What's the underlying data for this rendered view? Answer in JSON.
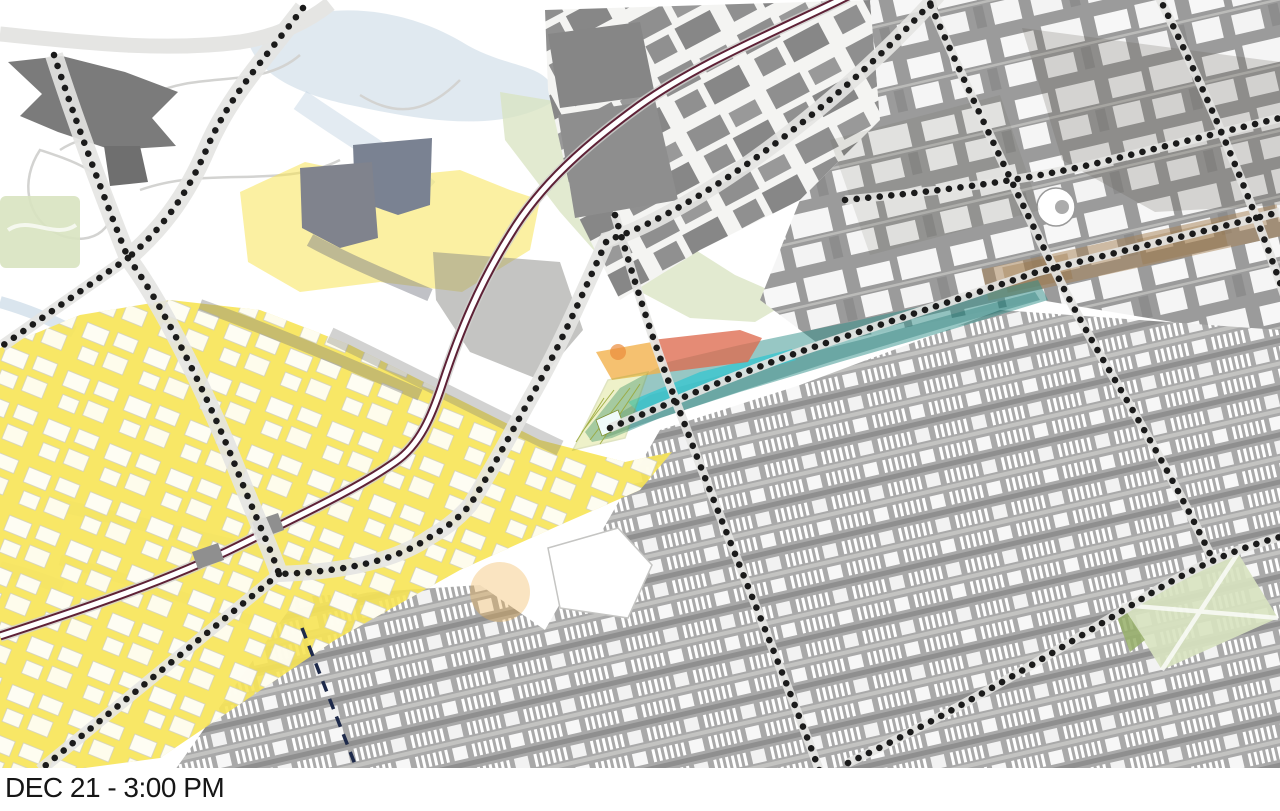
{
  "caption": "DEC 21 - 3:00 PM",
  "map": {
    "kind": "solar-shadow-study-plan",
    "date_label": "DEC 21",
    "time_label": "3:00 PM",
    "colors": {
      "background": "#FFFFFF",
      "ink": "#161616",
      "road": "#E5E5E3",
      "road_thin": "#D3D3D1",
      "block_gray": "#9B9B9B",
      "block_light": "#A9A9A9",
      "building_dark": "#7B7B7B",
      "sun_yellow": "#F7E455",
      "shadow_teal": "#2F8F8A",
      "shadow_cyan": "#3EC6CF",
      "impact_red": "#DE6A4E",
      "impact_orange": "#F2B14C",
      "park_green": "#D8E3C0",
      "water_blue": "#C2D3E2",
      "rail_maroon": "#5E2136",
      "grid_dot": "#1B1B1B",
      "dash_navy": "#1E2A4A",
      "band_brown": "#A88254"
    }
  }
}
